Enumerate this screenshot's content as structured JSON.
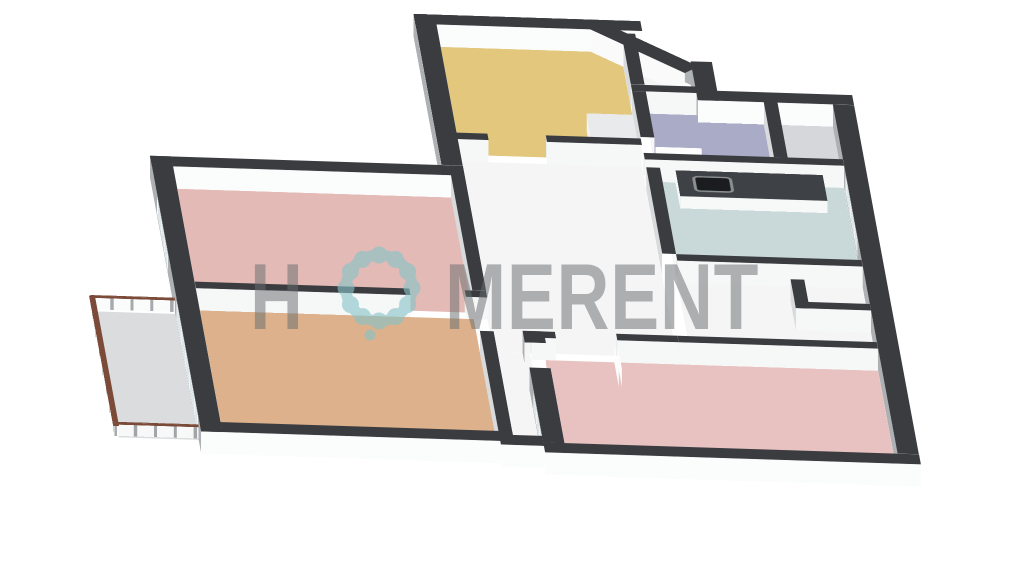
{
  "watermark": {
    "text_before_o": "H",
    "text_after_o": "MERENT",
    "text_color": "rgba(106,109,112,0.52)",
    "flower": {
      "color": "#86c3c9",
      "ring_radius": 33,
      "ring_width": 11,
      "petals": 12,
      "petal_radius": 8.5,
      "dot_x": -9,
      "dot_y": 47,
      "dot_radius": 5.5,
      "size": 100
    }
  },
  "palette": {
    "background": "#ffffff",
    "wall_top": "#3a3c40",
    "ext_side": "#adb1b4",
    "ext_bright": "#fbfcfc",
    "int_shade": "#d8dadc",
    "int_bright": "#f6f7f7",
    "int_north": "#eceeee",
    "chamfer_out": "#b0b4b6",
    "chamfer_in": "#fafafa",
    "door_leaf": "#fdfdfe",
    "window_frame": "#fdfdfd",
    "glass": "#dde6e9",
    "rail_cap": "#7b4a38",
    "rail_glass": "rgba(250,251,251,0.9)",
    "rail_post": "rgba(150,155,158,0.85)",
    "sink_basin": "#1a1c1f",
    "sink_rim": "#898f92",
    "counter_top": "#3e4145"
  },
  "plan": {
    "wall_height": 36,
    "rail_height": 22,
    "floors": [
      {
        "n": "yellow-room",
        "x": 190,
        "y": -170,
        "w": 120,
        "h": 150,
        "c": "#e2c77d"
      },
      {
        "n": "entry",
        "x": 319,
        "y": -155,
        "w": 38,
        "h": 60,
        "c": "#f4f4f5",
        "clip": "polygon(0 0, 35% 0, 100% 70%, 100% 100%, 0 100%)"
      },
      {
        "n": "bathroom",
        "x": 319,
        "y": -86,
        "w": 76,
        "h": 86,
        "c": "#aaabc6"
      },
      {
        "n": "wc",
        "x": 404,
        "y": -86,
        "w": 36,
        "h": 86,
        "c": "#d6d7db"
      },
      {
        "n": "kitchen",
        "x": 319,
        "y": 9,
        "w": 121,
        "h": 131,
        "c": "#c9d9da"
      },
      {
        "n": "hallway",
        "x": 190,
        "y": -11,
        "w": 120,
        "h": 265,
        "c": "#f5f5f6"
      },
      {
        "n": "hallway-east",
        "x": 319,
        "y": 149,
        "w": 121,
        "h": 105,
        "c": "#f5f5f6"
      },
      {
        "n": "shaft",
        "x": 400,
        "y": 170,
        "w": 40,
        "h": 31,
        "c": "#d4d5d7"
      },
      {
        "n": "bedroom-1",
        "x": 0,
        "y": 40,
        "w": 181,
        "h": 160,
        "c": "#e3bab5"
      },
      {
        "n": "living-room",
        "x": 0,
        "y": 209,
        "w": 181,
        "h": 186,
        "c": "#dcb18b"
      },
      {
        "n": "balcony",
        "x": -66,
        "y": 215,
        "w": 66,
        "h": 175,
        "c": "#dadcdd"
      },
      {
        "n": "hallway-stub",
        "x": 190,
        "y": 254,
        "w": 24,
        "h": 146,
        "c": "#f5f5f6"
      },
      {
        "n": "bedroom-2",
        "x": 223,
        "y": 263,
        "w": 217,
        "h": 146,
        "c": "#e8c2c1"
      }
    ],
    "walls": [
      {
        "n": "ext-north",
        "d": "h",
        "x": 176,
        "y": -184,
        "len": 148,
        "t": 14,
        "ext": true
      },
      {
        "n": "ext-chamfer",
        "d": "dg",
        "x": 296,
        "y": -184,
        "len": 86,
        "t": 14,
        "ext": true
      },
      {
        "n": "ext-entry-east",
        "d": "v",
        "x": 352,
        "y": -130,
        "len": 54,
        "t": 14,
        "ext": true
      },
      {
        "n": "ext-wc-north",
        "d": "h",
        "x": 352,
        "y": -90,
        "len": 102,
        "t": 14,
        "ext": true
      },
      {
        "n": "ext-east",
        "d": "v",
        "x": 440,
        "y": -76,
        "len": 485,
        "t": 14,
        "ext": true,
        "wins": [
          {
            "off": 96,
            "len": 90,
            "panes": 3,
            "z0": 5,
            "z1": 32
          }
        ]
      },
      {
        "n": "ext-south",
        "d": "h",
        "x": 209,
        "y": 409,
        "len": 245,
        "t": 14,
        "ext": true
      },
      {
        "n": "ext-bed2-west-a",
        "d": "v",
        "x": 209,
        "y": 254,
        "len": 16,
        "t": 14,
        "ext": true
      },
      {
        "n": "ext-bed2-west-b",
        "d": "v",
        "x": 209,
        "y": 305,
        "len": 104,
        "t": 14,
        "ext": true,
        "wins": [
          {
            "off": 30,
            "len": 65,
            "panes": 3,
            "z0": 5,
            "z1": 32
          }
        ]
      },
      {
        "n": "ext-stub-south",
        "d": "h",
        "x": 181,
        "y": 400,
        "len": 33,
        "t": 14,
        "ext": true
      },
      {
        "n": "ext-living-south",
        "d": "h",
        "x": -14,
        "y": 395,
        "len": 204,
        "t": 14,
        "ext": true
      },
      {
        "n": "ext-west",
        "d": "v",
        "x": -14,
        "y": 26,
        "len": 383,
        "t": 14,
        "ext": true,
        "wins": [
          {
            "off": 54,
            "len": 80,
            "panes": 3,
            "z0": 5,
            "z1": 32
          },
          {
            "off": 199,
            "len": 160,
            "panes": 5,
            "z0": 2,
            "z1": 33
          }
        ]
      },
      {
        "n": "ext-bed1-north",
        "d": "h",
        "x": -14,
        "y": 26,
        "len": 199,
        "t": 14,
        "ext": true
      },
      {
        "n": "ext-yellow-west",
        "d": "v",
        "x": 176,
        "y": -184,
        "len": 210,
        "t": 14,
        "ext": true
      },
      {
        "n": "int-bed1-south-a",
        "d": "h",
        "x": 0,
        "y": 200,
        "len": 140,
        "t": 9
      },
      {
        "n": "int-bed1-south-b",
        "d": "h",
        "x": 176,
        "y": 200,
        "len": 14,
        "t": 9
      },
      {
        "n": "int-bed1-east",
        "d": "v",
        "x": 181,
        "y": 26,
        "len": 174,
        "t": 9
      },
      {
        "n": "int-living-east",
        "d": "v",
        "x": 181,
        "y": 256,
        "len": 144,
        "t": 9
      },
      {
        "n": "int-yellow-south-a",
        "d": "h",
        "x": 181,
        "y": -20,
        "len": 29,
        "t": 9
      },
      {
        "n": "int-yellow-south-b",
        "d": "h",
        "x": 248,
        "y": -20,
        "len": 62,
        "t": 9
      },
      {
        "n": "int-yellow-east",
        "d": "v",
        "x": 310,
        "y": -166,
        "len": 71,
        "t": 9
      },
      {
        "n": "int-bath-north",
        "d": "h",
        "x": 310,
        "y": -95,
        "len": 47,
        "t": 9
      },
      {
        "n": "int-bath-west",
        "d": "v",
        "x": 310,
        "y": -86,
        "len": 64,
        "t": 9
      },
      {
        "n": "int-bath-wc",
        "d": "v",
        "x": 395,
        "y": -86,
        "len": 86,
        "t": 9
      },
      {
        "n": "int-kitchen-north",
        "d": "h",
        "x": 310,
        "y": 0,
        "len": 130,
        "t": 9
      },
      {
        "n": "int-kitchen-west",
        "d": "v",
        "x": 310,
        "y": 20,
        "len": 120,
        "t": 9
      },
      {
        "n": "int-kitchen-south",
        "d": "h",
        "x": 319,
        "y": 140,
        "len": 121,
        "t": 9
      },
      {
        "n": "int-shaft-west",
        "d": "v",
        "x": 391,
        "y": 170,
        "len": 40,
        "t": 9
      },
      {
        "n": "int-shaft-south",
        "d": "h",
        "x": 391,
        "y": 201,
        "len": 49,
        "t": 9
      },
      {
        "n": "int-bed2-north-a",
        "d": "h",
        "x": 214,
        "y": 254,
        "len": 16,
        "t": 9
      },
      {
        "n": "int-bed2-north-b",
        "d": "h",
        "x": 270,
        "y": 254,
        "len": 40,
        "t": 9
      },
      {
        "n": "int-bed2-north-c",
        "d": "h",
        "x": 310,
        "y": 254,
        "len": 130,
        "t": 9
      },
      {
        "n": "door-leaf-bath",
        "d": "h",
        "x": 319,
        "y": -14,
        "len": 30,
        "t": 2,
        "leaf": true,
        "h": 30
      },
      {
        "n": "door-leaf-bed2",
        "d": "v",
        "x": 268,
        "y": 263,
        "len": 34,
        "t": 2,
        "leaf": true,
        "h": 30
      },
      {
        "n": "door-leaf-entry",
        "d": "dg",
        "x": 318,
        "y": -166,
        "len": 36,
        "t": 2,
        "leaf": true,
        "h": 30
      }
    ],
    "boxes": [
      {
        "n": "kitchen-counter",
        "x": 330,
        "y": 9,
        "w": 96,
        "h": 36,
        "z": 20,
        "side": "#f7f8f8",
        "top": "#3e4145",
        "sink": true
      },
      {
        "n": "wardrobe",
        "x": 278,
        "y": -58,
        "w": 30,
        "h": 36,
        "z": 30,
        "side": "#f2f3f4",
        "top": "#e9eaec"
      }
    ],
    "sink": {
      "x": 10,
      "y": 7,
      "w": 26,
      "h": 22
    },
    "rails": [
      {
        "n": "balcony-rail-west",
        "d": "v",
        "x": -69,
        "y": 212,
        "len": 181
      },
      {
        "n": "balcony-rail-north",
        "d": "h",
        "x": -69,
        "y": 212,
        "len": 69
      },
      {
        "n": "balcony-rail-south",
        "d": "h",
        "x": -69,
        "y": 388,
        "len": 69
      }
    ]
  }
}
